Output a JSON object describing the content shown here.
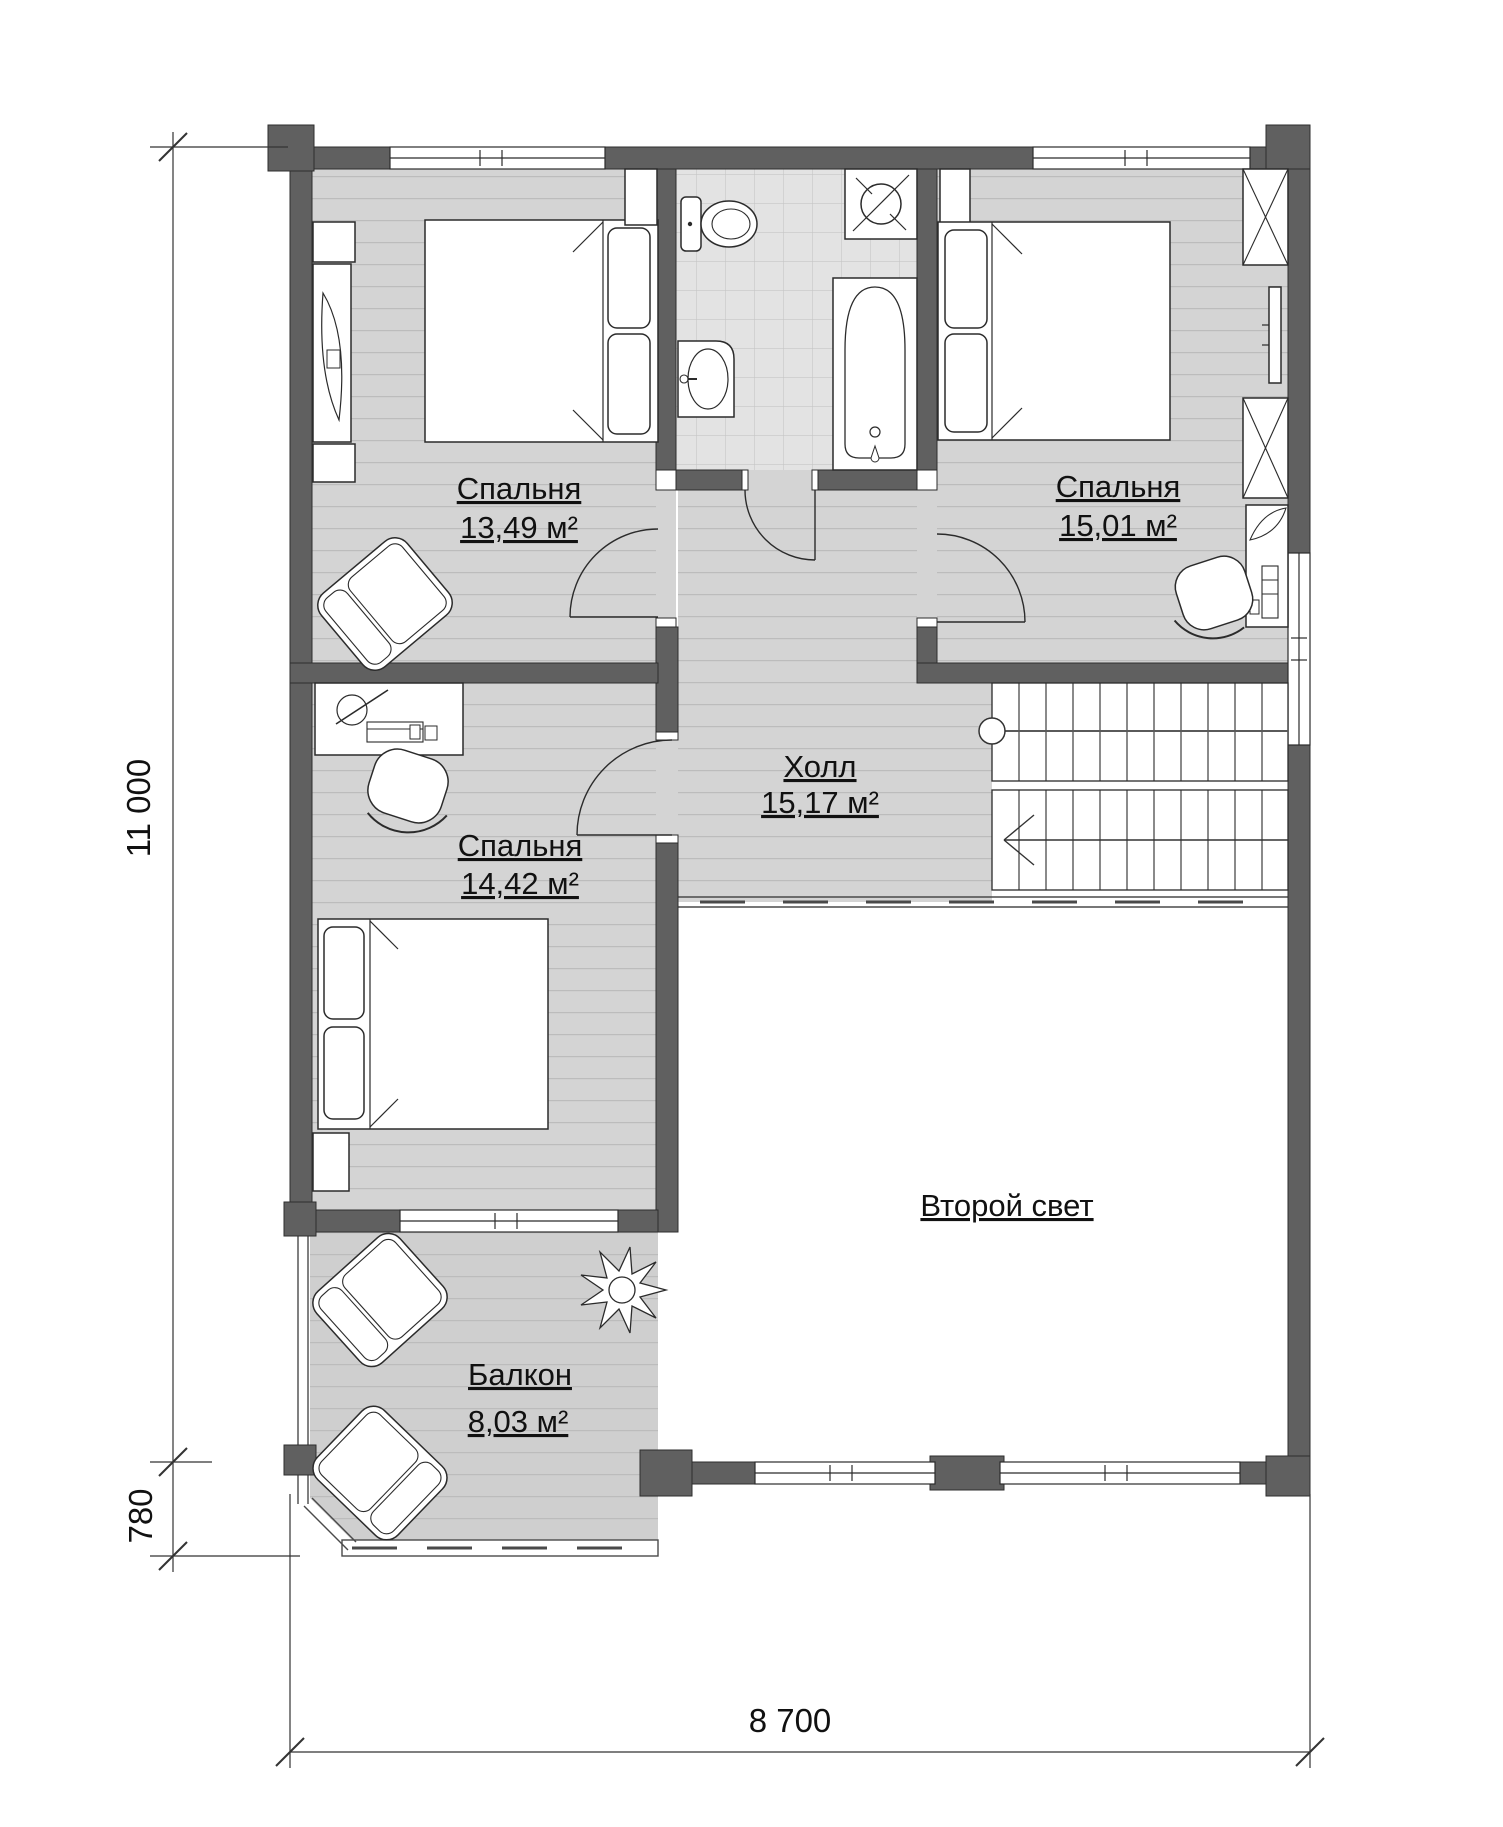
{
  "rooms": {
    "bedroom1": {
      "name": "Спальня",
      "area": "13,49 м²"
    },
    "bedroom2": {
      "name": "Спальня",
      "area": "15,01 м²"
    },
    "bedroom3": {
      "name": "Спальня",
      "area": "14,42 м²"
    },
    "hall": {
      "name": "Холл",
      "area": "15,17 м²"
    },
    "balcony": {
      "name": "Балкон",
      "area": "8,03 м²"
    },
    "second_light": {
      "name": "Второй свет"
    }
  },
  "dimensions": {
    "height_total": "11 000",
    "balcony_depth": "780",
    "width_total": "8 700"
  },
  "colors": {
    "wall": "#606060",
    "wood_floor": "#d4d4d4",
    "plank_line": "#bcbcbc",
    "tile_floor": "#e3e3e3",
    "tile_line": "#c6c6c6",
    "balcony_floor": "#cfcfcf",
    "line": "#2b2b2b"
  },
  "fixtures": [
    "double-bed",
    "pillow",
    "dresser",
    "tv-panel",
    "wardrobe",
    "armchair",
    "desk",
    "desk-chair",
    "keyboard",
    "plant",
    "toilet",
    "washing-machine",
    "bathtub",
    "sink",
    "stairs",
    "window",
    "door-swing",
    "guard-rail"
  ]
}
